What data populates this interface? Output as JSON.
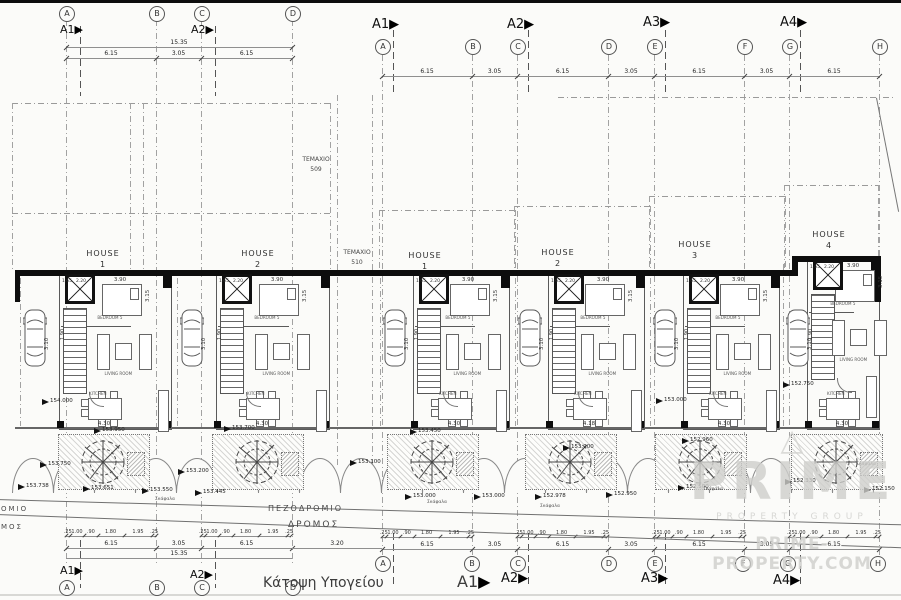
{
  "title": {
    "text": "Κάτοψη Υπογείου",
    "marker": "A1"
  },
  "watermark": {
    "glyph": "△",
    "brand": "PRIME",
    "tagline": "PROPERTY GROUP",
    "url": "PRIME-PROPERTY.COM"
  },
  "grid_letters": {
    "left_top": [
      "A",
      "B",
      "C",
      "D"
    ],
    "right_top": [
      "A",
      "B",
      "C",
      "D",
      "E",
      "F",
      "G",
      "H"
    ],
    "left_bottom": [
      "A",
      "B",
      "C",
      "D"
    ],
    "right_bottom": [
      "A",
      "B",
      "C",
      "D",
      "E",
      "F",
      "G",
      "H"
    ]
  },
  "section_markers": {
    "left_top": [
      "A1",
      "A2"
    ],
    "right_top": [
      "A1",
      "A2",
      "A3",
      "A4"
    ],
    "left_bottom": [
      "A1",
      "A2"
    ],
    "right_bottom": [
      "A2",
      "A3",
      "A4"
    ],
    "arrow": "▶"
  },
  "dims": {
    "left_total": "15.35",
    "left_segments": [
      "6.15",
      "3.05",
      "6.15"
    ],
    "right_segments": [
      "6.15",
      "3.05",
      "6.15",
      "3.05",
      "6.15",
      "3.05",
      "6.15"
    ],
    "bottom_left_segments": [
      "6.15",
      "3.05",
      "6.15"
    ],
    "bottom_left_total": "15.35",
    "gap": "3.20",
    "bottom_right_segments": [
      "6.15",
      "3.05",
      "6.15",
      "3.05",
      "6.15",
      "3.05",
      "6.15"
    ],
    "small_run": [
      ".25",
      "1.00",
      ".90",
      "1.80",
      "1.95",
      ".25"
    ],
    "bedroom_w": "3.90",
    "bedroom_d": "3.15",
    "bay": "3.10",
    "living": "4.30",
    "living_alt": "4.18",
    "stair_a": "1.65",
    "stair_b": "2.20",
    "side": "1.90"
  },
  "houses": [
    {
      "name": "HOUSE",
      "no": "1"
    },
    {
      "name": "HOUSE",
      "no": "2"
    },
    {
      "name": "HOUSE",
      "no": "1"
    },
    {
      "name": "HOUSE",
      "no": "2"
    },
    {
      "name": "HOUSE",
      "no": "3"
    },
    {
      "name": "HOUSE",
      "no": "4"
    }
  ],
  "rooms": {
    "bedroom": "BEDROOM 5",
    "living": "LIVING ROOM",
    "kitchen": "KITCHEN"
  },
  "parcels": [
    {
      "name": "ΤΕΜΑΧΙΟ",
      "no": "509"
    },
    {
      "name": "ΤΕΜΑΧΙΟ",
      "no": "510"
    }
  ],
  "streets": {
    "sidewalk": "ΠΕΖΟΔΡΟΜΙΟ",
    "road": "ΔΡΟΜΟΣ",
    "sidewalk_cut": "ΟΜΙΟ",
    "road_cut": "ΜΟΣ"
  },
  "planter_note": "Σκάφαλα",
  "levels": [
    {
      "v": "154.000",
      "x": 50,
      "y": 400
    },
    {
      "v": "153.950",
      "x": 102,
      "y": 429
    },
    {
      "v": "153.700",
      "x": 232,
      "y": 427
    },
    {
      "v": "153.750",
      "x": 48,
      "y": 463
    },
    {
      "v": "153.738",
      "x": 26,
      "y": 485
    },
    {
      "v": "153.651",
      "x": 91,
      "y": 487
    },
    {
      "v": "153.550",
      "x": 150,
      "y": 489
    },
    {
      "v": "153.445",
      "x": 203,
      "y": 491
    },
    {
      "v": "153.200",
      "x": 186,
      "y": 470
    },
    {
      "v": "153.450",
      "x": 418,
      "y": 430
    },
    {
      "v": "153.100",
      "x": 358,
      "y": 461
    },
    {
      "v": "153.000",
      "x": 413,
      "y": 495
    },
    {
      "v": "153.000",
      "x": 482,
      "y": 495
    },
    {
      "v": "153.200",
      "x": 571,
      "y": 446
    },
    {
      "v": "152.978",
      "x": 543,
      "y": 495
    },
    {
      "v": "152.950",
      "x": 614,
      "y": 493
    },
    {
      "v": "153.000",
      "x": 664,
      "y": 399
    },
    {
      "v": "152.960",
      "x": 690,
      "y": 439
    },
    {
      "v": "152.500",
      "x": 686,
      "y": 486
    },
    {
      "v": "152.750",
      "x": 791,
      "y": 383
    },
    {
      "v": "152.330",
      "x": 793,
      "y": 480
    },
    {
      "v": "152.150",
      "x": 872,
      "y": 488
    }
  ]
}
